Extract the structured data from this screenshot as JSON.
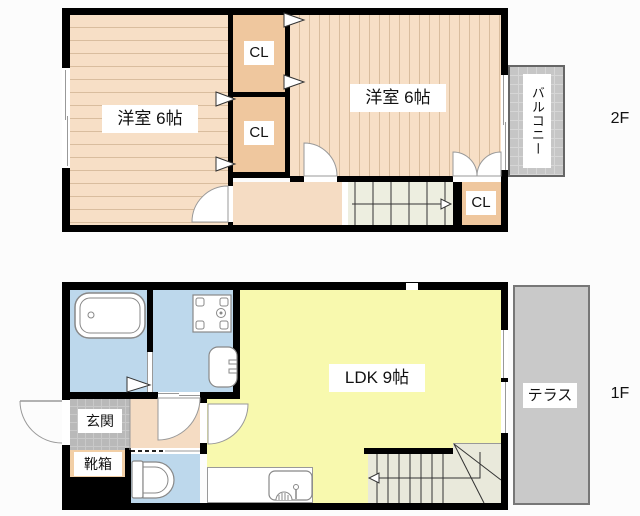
{
  "document_type": "apartment-floor-plan",
  "floor_plan": {
    "floors": [
      {
        "id": "2F",
        "floor_label": "2F",
        "rooms": [
          {
            "name": "western-room-left",
            "label": "洋室 6帖"
          },
          {
            "name": "western-room-right",
            "label": "洋室 6帖"
          },
          {
            "name": "closet-1",
            "label": "CL"
          },
          {
            "name": "closet-2",
            "label": "CL"
          },
          {
            "name": "closet-3",
            "label": "CL"
          },
          {
            "name": "balcony",
            "label": "バルコニー"
          }
        ],
        "features": [
          "staircase-down",
          "double-closet-doors",
          "sliding-window"
        ]
      },
      {
        "id": "1F",
        "floor_label": "1F",
        "rooms": [
          {
            "name": "ldk",
            "label": "LDK 9帖"
          },
          {
            "name": "entrance",
            "label": "玄関"
          },
          {
            "name": "shoe-cabinet",
            "label": "靴箱"
          },
          {
            "name": "terrace",
            "label": "テラス"
          }
        ],
        "features": [
          "bathtub",
          "washing-machine-pan",
          "washbasin",
          "toilet",
          "kitchen-sink",
          "staircase-up",
          "entrance-door"
        ]
      }
    ]
  },
  "colors": {
    "bg": "#fcfcfc",
    "wall": "#000000",
    "wood": "#f7dfc6",
    "wood_line": "#d9bd9e",
    "closet": "#efc79e",
    "hall": "#f5dcc3",
    "stairs_2f": "#edeee0",
    "stairs_1f": "#e9e9db",
    "water": "#bdd8ec",
    "ldk": "#f8f9ae",
    "balcony": "#c6c6c6",
    "balcony_line": "#d6d6d6",
    "terrace": "#c9c9c9",
    "genkan": "#b9b9b9",
    "genkan_line": "#c9c9c9",
    "shoebox": "#f2cfa6",
    "label_bg": "#ffffff"
  }
}
